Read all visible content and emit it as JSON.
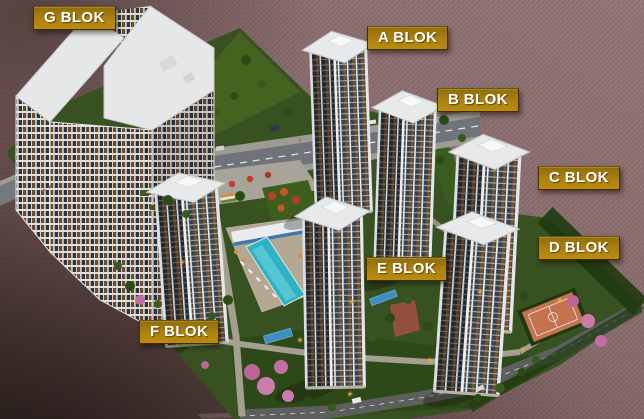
{
  "blocks": [
    {
      "id": "g",
      "label": "G BLOK"
    },
    {
      "id": "a",
      "label": "A BLOK"
    },
    {
      "id": "b",
      "label": "B BLOK"
    },
    {
      "id": "c",
      "label": "C BLOK"
    },
    {
      "id": "d",
      "label": "D BLOK"
    },
    {
      "id": "e",
      "label": "E BLOK"
    },
    {
      "id": "f",
      "label": "F BLOK"
    }
  ],
  "colors": {
    "label_background": "#a87f10",
    "label_text": "#ffffff",
    "background_mauve": "#8a6d6e",
    "grass": "#375220",
    "pool_water": "#2fb3c4",
    "sport_court": "#c4724f",
    "road": "#70747a"
  }
}
